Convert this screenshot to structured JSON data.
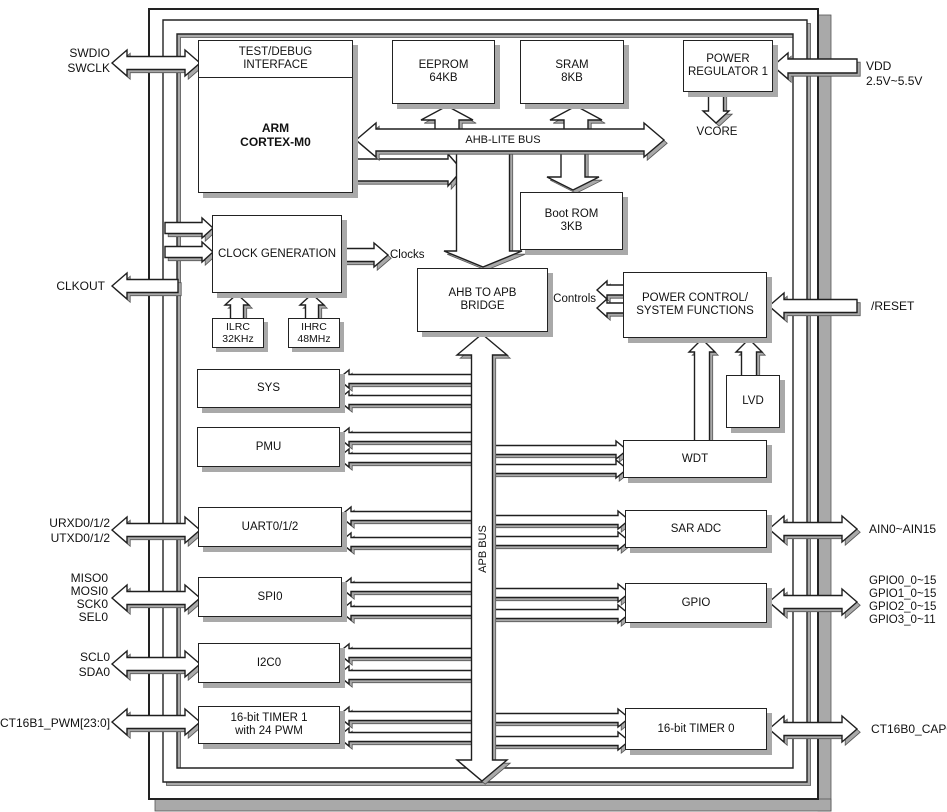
{
  "diagram": {
    "title": "MCU block diagram",
    "colors": {
      "line": "#1f1f1f",
      "shadow": "#a9a9a9",
      "fill": "#ffffff",
      "background": "#ffffff"
    },
    "blocks": {
      "test_debug": "TEST/DEBUG\nINTERFACE",
      "arm": "ARM\nCORTEX-M0",
      "eeprom": "EEPROM\n64KB",
      "sram": "SRAM\n8KB",
      "power_regulator": "POWER\nREGULATOR 1",
      "boot_rom": "Boot ROM\n3KB",
      "clock_generation": "CLOCK GENERATION",
      "ilrc": "ILRC\n32KHz",
      "ihrc": "IHRC\n48MHz",
      "ahb_apb_bridge": "AHB TO APB\nBRIDGE",
      "power_control": "POWER CONTROL/\nSYSTEM FUNCTIONS",
      "lvd": "LVD",
      "sys": "SYS",
      "pmu": "PMU",
      "wdt": "WDT",
      "uart": "UART0/1/2",
      "spi": "SPI0",
      "i2c": "I2C0",
      "timer1": "16-bit TIMER 1\nwith 24 PWM",
      "sar_adc": "SAR ADC",
      "gpio": "GPIO",
      "timer0": "16-bit TIMER 0"
    },
    "buses": {
      "ahb": "AHB-LITE BUS",
      "apb": "APB BUS"
    },
    "nets": {
      "clocks": "Clocks",
      "controls": "Controls",
      "vcore": "VCORE"
    },
    "pins": {
      "left": [
        {
          "label": "SWDIO\nSWCLK"
        },
        {
          "label": "CLKOUT"
        },
        {
          "label": "URXD0/1/2\nUTXD0/1/2"
        },
        {
          "label": "MISO0\nMOSI0\nSCK0\nSEL0"
        },
        {
          "label": "SCL0\nSDA0"
        },
        {
          "label": "CT16B1_PWM[23:0]"
        }
      ],
      "right": [
        {
          "label": "VDD 2.5V~5.5V"
        },
        {
          "label": "/RESET"
        },
        {
          "label": "AIN0~AIN15"
        },
        {
          "label": "GPIO0_0~15\nGPIO1_0~15\nGPIO2_0~15\nGPIO3_0~11"
        },
        {
          "label": "CT16B0_CAP0"
        }
      ]
    }
  }
}
